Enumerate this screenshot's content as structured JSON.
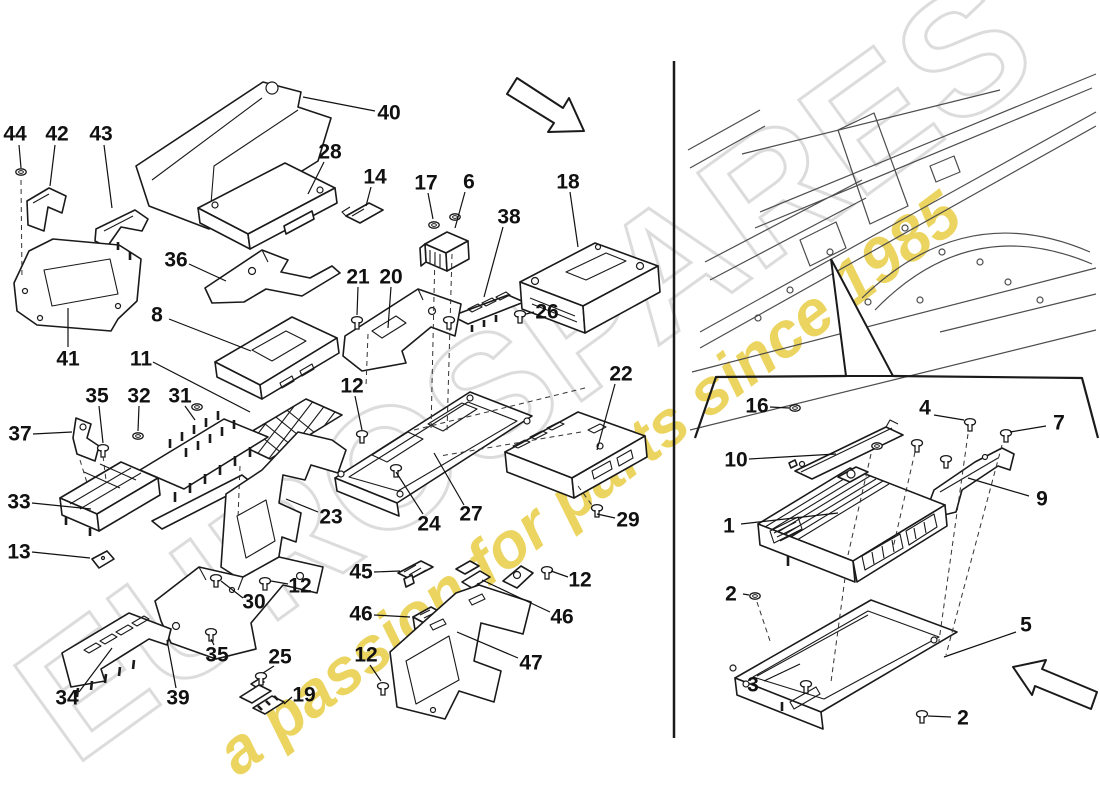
{
  "watermark": {
    "brand": "EUROSPARES",
    "tagline": "a passion for parts since 1985",
    "brand_color": "#dcdcdc",
    "tagline_color": "#e6ca3c"
  },
  "colors": {
    "line": "#1a1a1a",
    "background": "#ffffff"
  },
  "callouts": [
    {
      "label": "44",
      "x": 15,
      "y": 134,
      "l": [
        19,
        145,
        21,
        168
      ]
    },
    {
      "label": "42",
      "x": 57,
      "y": 134,
      "l": [
        55,
        145,
        50,
        186
      ]
    },
    {
      "label": "43",
      "x": 101,
      "y": 134,
      "l": [
        104,
        145,
        112,
        208
      ]
    },
    {
      "label": "40",
      "x": 389,
      "y": 113,
      "l": [
        375,
        111,
        303,
        97
      ]
    },
    {
      "label": "28",
      "x": 330,
      "y": 152,
      "l": [
        324,
        162,
        308,
        194
      ]
    },
    {
      "label": "14",
      "x": 375,
      "y": 177,
      "l": [
        371,
        187,
        366,
        206
      ]
    },
    {
      "label": "17",
      "x": 426,
      "y": 183,
      "l": [
        428,
        193,
        433,
        219
      ]
    },
    {
      "label": "6",
      "x": 469,
      "y": 182,
      "l": [
        465,
        192,
        455,
        228
      ]
    },
    {
      "label": "18",
      "x": 568,
      "y": 182,
      "l": [
        570,
        192,
        578,
        247
      ]
    },
    {
      "label": "38",
      "x": 509,
      "y": 217,
      "l": [
        503,
        227,
        484,
        297
      ]
    },
    {
      "label": "36",
      "x": 176,
      "y": 260,
      "l": [
        189,
        264,
        226,
        281
      ]
    },
    {
      "label": "21",
      "x": 358,
      "y": 277,
      "l": [
        358,
        287,
        357,
        315
      ]
    },
    {
      "label": "20",
      "x": 391,
      "y": 277,
      "l": [
        391,
        287,
        388,
        328
      ]
    },
    {
      "label": "26",
      "x": 547,
      "y": 312,
      "l": [
        534,
        312,
        526,
        314
      ]
    },
    {
      "label": "8",
      "x": 157,
      "y": 315,
      "l": [
        169,
        319,
        251,
        351
      ]
    },
    {
      "label": "11",
      "x": 141,
      "y": 359,
      "l": [
        153,
        362,
        250,
        412
      ]
    },
    {
      "label": "41",
      "x": 68,
      "y": 359,
      "l": [
        68,
        347,
        68,
        308
      ]
    },
    {
      "label": "35",
      "x": 97,
      "y": 396,
      "l": [
        99,
        406,
        103,
        443
      ]
    },
    {
      "label": "32",
      "x": 139,
      "y": 396,
      "l": [
        139,
        406,
        138,
        431
      ]
    },
    {
      "label": "31",
      "x": 180,
      "y": 396,
      "l": [
        185,
        406,
        195,
        420
      ]
    },
    {
      "label": "12",
      "x": 352,
      "y": 386,
      "l": [
        355,
        396,
        362,
        430
      ]
    },
    {
      "label": "37",
      "x": 20,
      "y": 434,
      "l": [
        33,
        434,
        72,
        432
      ]
    },
    {
      "label": "33",
      "x": 19,
      "y": 502,
      "l": [
        32,
        503,
        91,
        509
      ]
    },
    {
      "label": "13",
      "x": 19,
      "y": 552,
      "l": [
        32,
        552,
        90,
        558
      ]
    },
    {
      "label": "23",
      "x": 331,
      "y": 517,
      "l": [
        318,
        512,
        286,
        499
      ]
    },
    {
      "label": "24",
      "x": 429,
      "y": 524,
      "l": [
        423,
        514,
        396,
        472
      ]
    },
    {
      "label": "27",
      "x": 471,
      "y": 514,
      "l": [
        464,
        505,
        434,
        453
      ]
    },
    {
      "label": "22",
      "x": 621,
      "y": 374,
      "l": [
        615,
        384,
        597,
        450
      ]
    },
    {
      "label": "29",
      "x": 628,
      "y": 520,
      "l": [
        615,
        518,
        597,
        514
      ]
    },
    {
      "label": "12",
      "x": 300,
      "y": 586,
      "l": [
        288,
        584,
        271,
        581
      ]
    },
    {
      "label": "30",
      "x": 254,
      "y": 602,
      "l": [
        243,
        598,
        221,
        581
      ]
    },
    {
      "label": "35",
      "x": 217,
      "y": 655,
      "l": [
        214,
        645,
        211,
        639
      ]
    },
    {
      "label": "34",
      "x": 67,
      "y": 698,
      "l": [
        79,
        692,
        112,
        648
      ]
    },
    {
      "label": "39",
      "x": 178,
      "y": 698,
      "l": [
        176,
        688,
        167,
        640
      ]
    },
    {
      "label": "25",
      "x": 280,
      "y": 657,
      "l": [
        274,
        666,
        263,
        673
      ]
    },
    {
      "label": "19",
      "x": 304,
      "y": 695,
      "l": [
        292,
        697,
        284,
        704
      ]
    },
    {
      "label": "12",
      "x": 366,
      "y": 655,
      "l": [
        370,
        665,
        381,
        681
      ]
    },
    {
      "label": "45",
      "x": 361,
      "y": 572,
      "l": [
        374,
        572,
        400,
        571
      ]
    },
    {
      "label": "46",
      "x": 361,
      "y": 614,
      "l": [
        374,
        615,
        410,
        617
      ]
    },
    {
      "label": "46",
      "x": 562,
      "y": 617,
      "l": [
        550,
        612,
        482,
        580
      ]
    },
    {
      "label": "12",
      "x": 580,
      "y": 580,
      "l": [
        568,
        577,
        551,
        571
      ]
    },
    {
      "label": "47",
      "x": 531,
      "y": 663,
      "l": [
        518,
        658,
        457,
        632
      ]
    },
    {
      "label": "16",
      "x": 757,
      "y": 406,
      "l": [
        770,
        407,
        789,
        408
      ]
    },
    {
      "label": "4",
      "x": 925,
      "y": 408,
      "l": [
        934,
        415,
        964,
        420
      ]
    },
    {
      "label": "7",
      "x": 1059,
      "y": 423,
      "l": [
        1046,
        426,
        1010,
        432
      ]
    },
    {
      "label": "10",
      "x": 736,
      "y": 460,
      "l": [
        749,
        459,
        836,
        454
      ]
    },
    {
      "label": "9",
      "x": 1042,
      "y": 499,
      "l": [
        1029,
        496,
        968,
        478
      ]
    },
    {
      "label": "1",
      "x": 729,
      "y": 526,
      "l": [
        741,
        524,
        838,
        513
      ]
    },
    {
      "label": "2",
      "x": 731,
      "y": 594,
      "l": [
        743,
        594,
        749,
        595
      ]
    },
    {
      "label": "3",
      "x": 753,
      "y": 685,
      "l": [
        764,
        681,
        800,
        664
      ]
    },
    {
      "label": "5",
      "x": 1026,
      "y": 625,
      "l": [
        1016,
        632,
        944,
        657
      ]
    },
    {
      "label": "2",
      "x": 963,
      "y": 718,
      "l": [
        951,
        717,
        928,
        716
      ]
    }
  ]
}
